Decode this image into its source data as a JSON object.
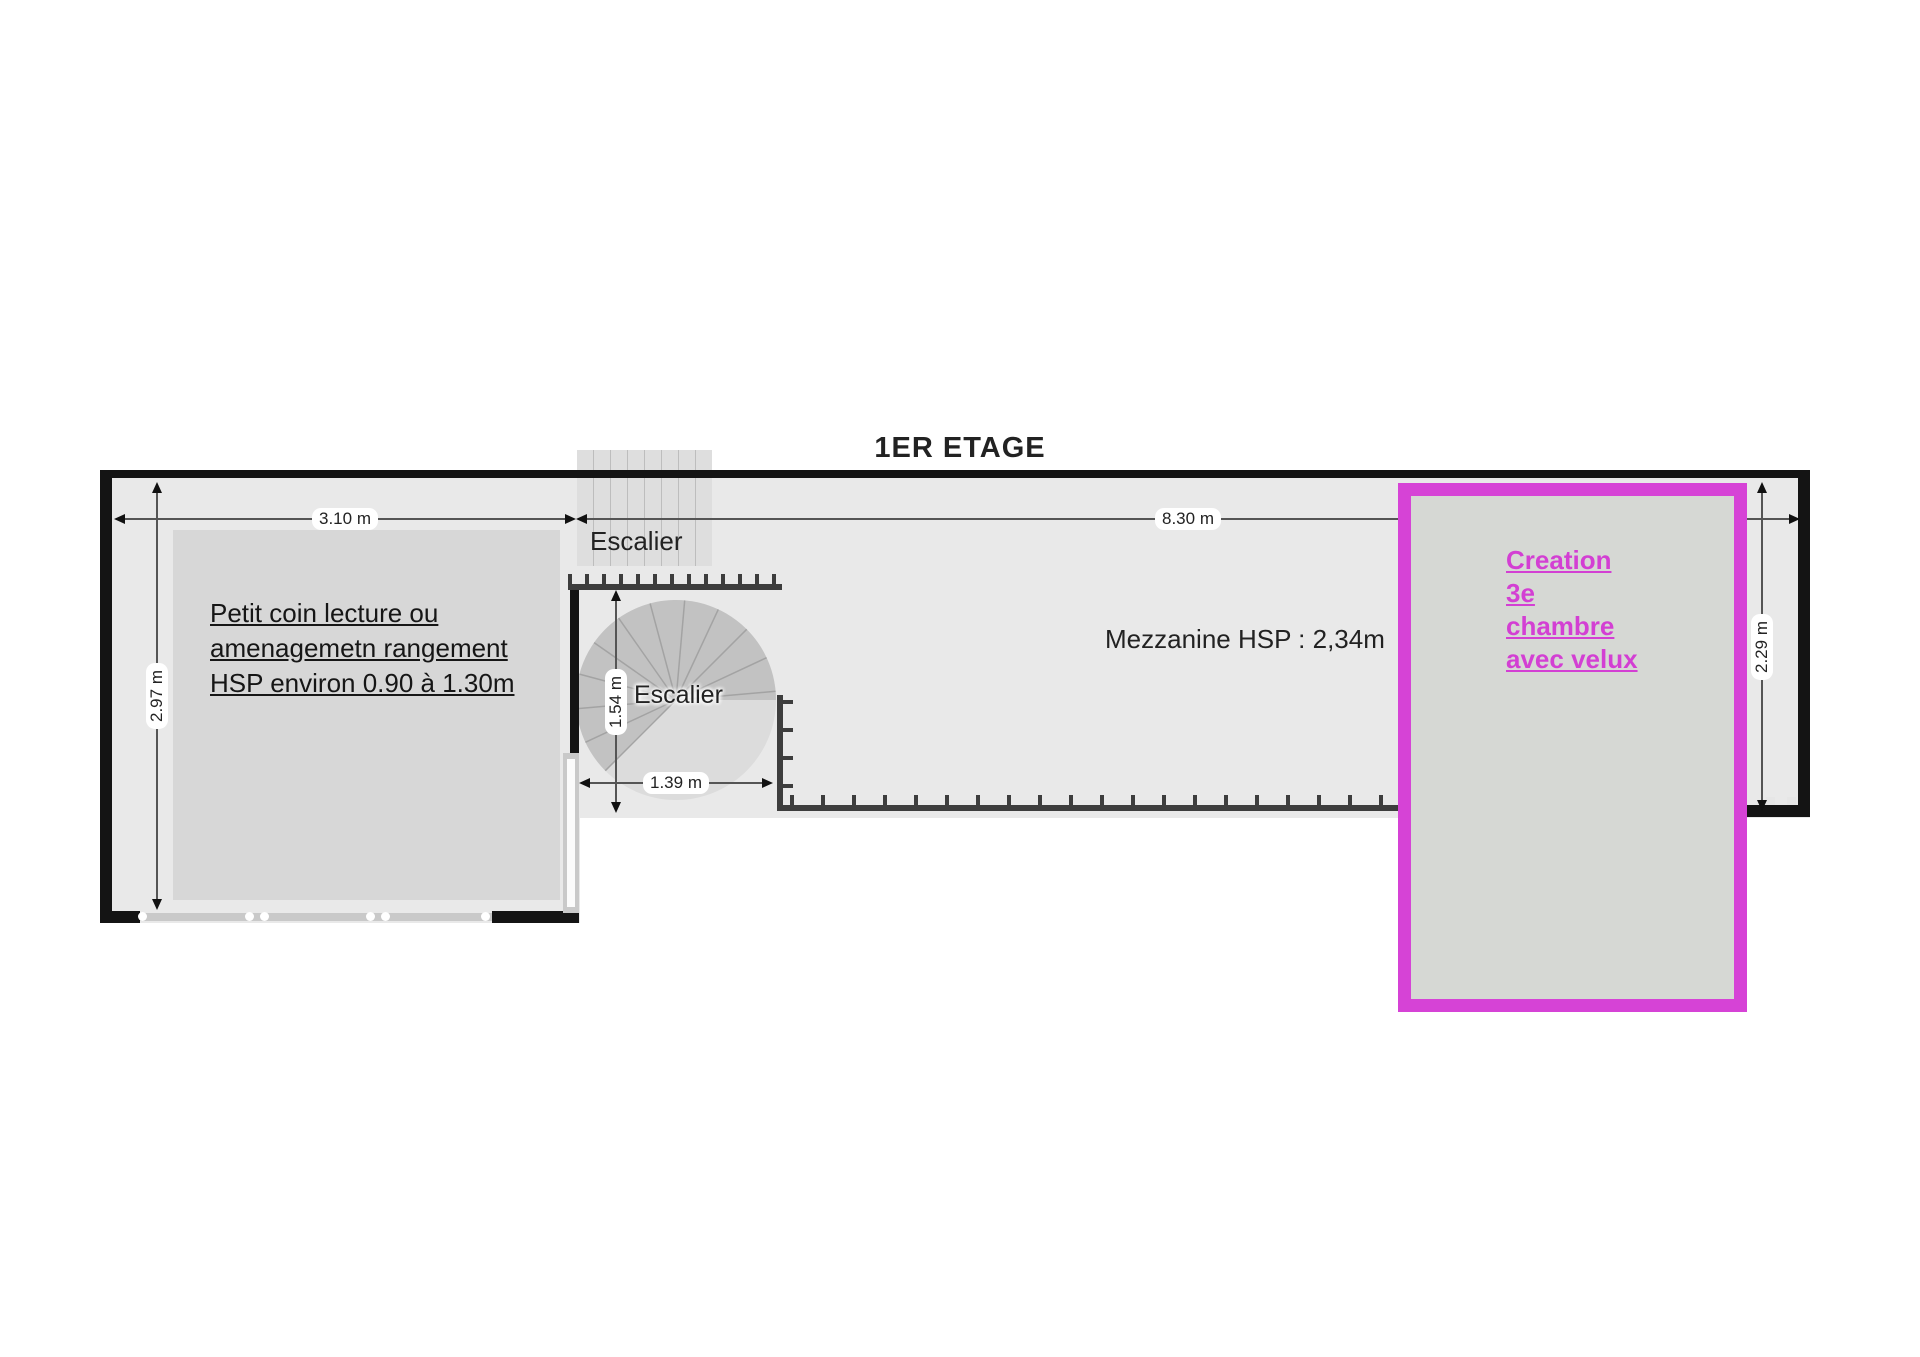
{
  "title": "1ER ETAGE",
  "left_room": {
    "note_line1": "Petit coin lecture ou",
    "note_line2": "amenagemetn rangement",
    "note_line3": "HSP environ 0.90 à 1.30m",
    "width_dim": "3.10 m",
    "height_dim": "2.97 m"
  },
  "stairs": {
    "top_label": "Escalier",
    "spiral_label": "Escalier",
    "height_dim": "1.54 m",
    "width_dim": "1.39 m"
  },
  "mezzanine": {
    "label": "Mezzanine HSP : 2,34m",
    "width_dim": "8.30 m",
    "height_dim": "2.29 m"
  },
  "new_room": {
    "line1": "Creation",
    "line2": "3e",
    "line3": "chambre",
    "line4": "avec velux"
  },
  "colors": {
    "highlight_magenta": "#d643d6",
    "floor_gray": "#e9e9e9",
    "inner_room_gray": "#d7d7d7",
    "wall_black": "#141414"
  }
}
